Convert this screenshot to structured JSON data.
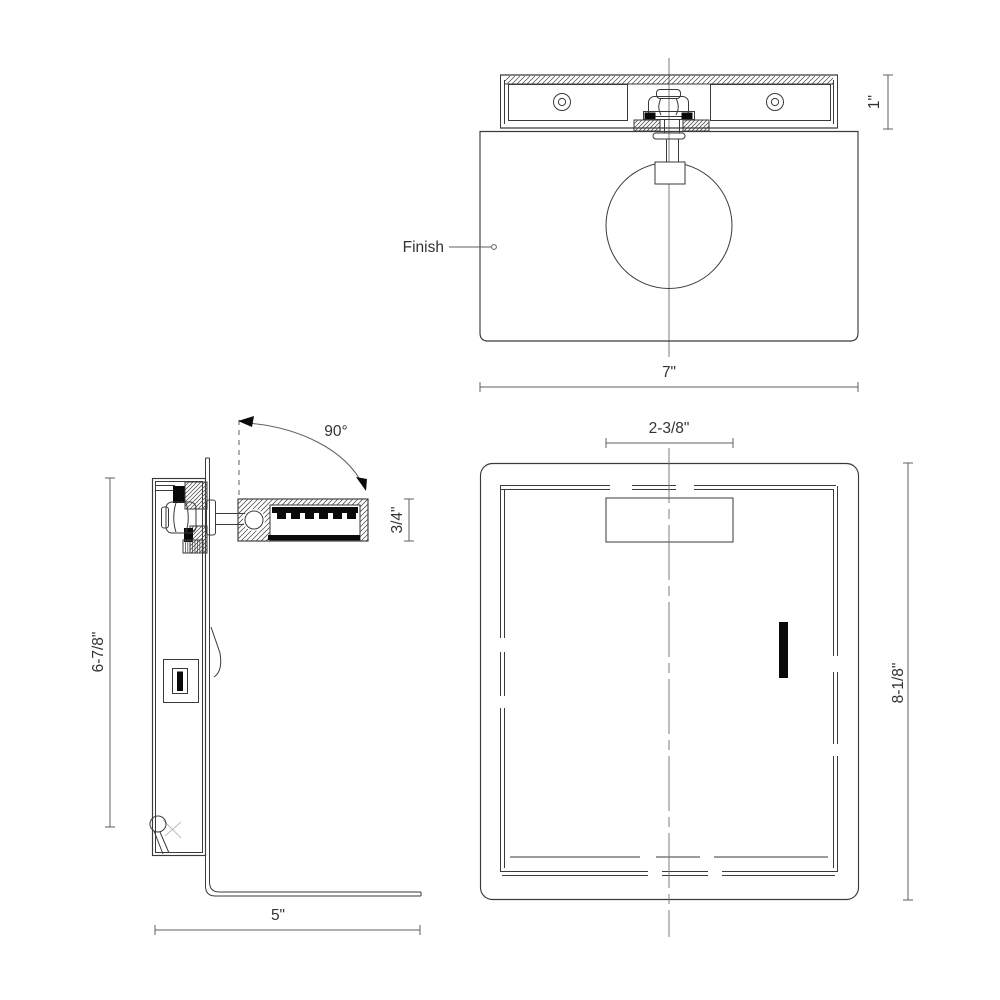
{
  "front_view": {
    "finish_label": "Finish",
    "width_dim": "7\"",
    "bracket_height_dim": "1\""
  },
  "side_view": {
    "rotation_angle": "90°",
    "arm_thickness_dim": "3/4\"",
    "height_dim": "6-7/8\"",
    "depth_dim": "5\""
  },
  "rear_view": {
    "mount_width_dim": "2-3/8\"",
    "height_dim": "8-1/8\""
  },
  "colors": {
    "background": "#ffffff",
    "line": "#3a3a3a",
    "dimension": "#5f5f5f",
    "fill": "#0a0a0a"
  }
}
